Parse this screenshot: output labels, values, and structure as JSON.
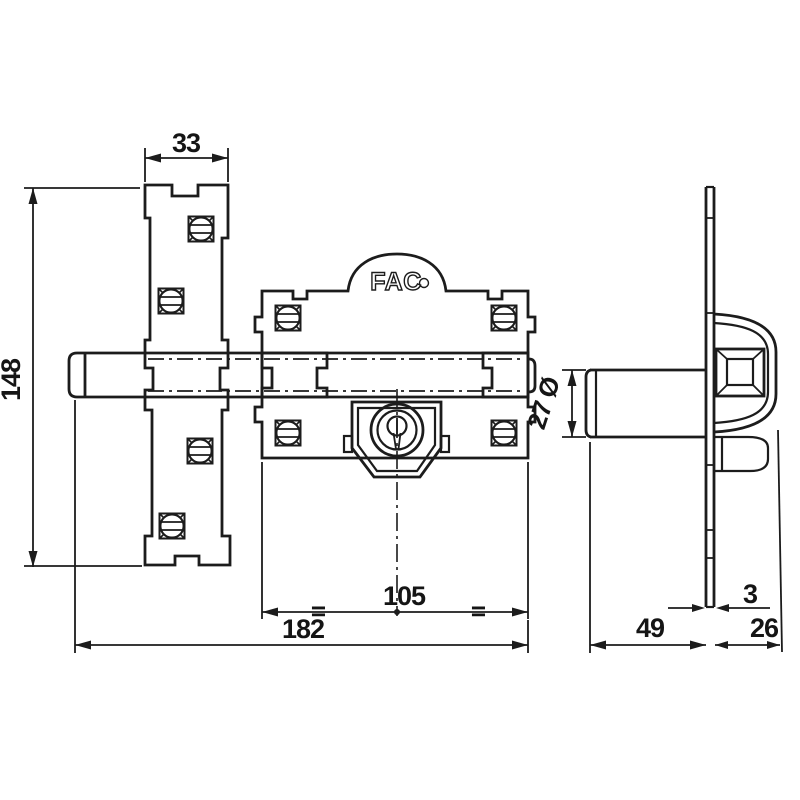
{
  "drawing": {
    "logo": "FAC",
    "dimensions": {
      "keep_width": "33",
      "keep_height": "148",
      "body_width": "105",
      "total_width": "182",
      "cylinder_diameter": "27 Ø",
      "plate_thickness": "3",
      "cylinder_depth": "49",
      "bracket_depth": "26",
      "symmetry_mark": "="
    },
    "colors": {
      "line": "#1c1c1c",
      "background": "#ffffff"
    }
  }
}
